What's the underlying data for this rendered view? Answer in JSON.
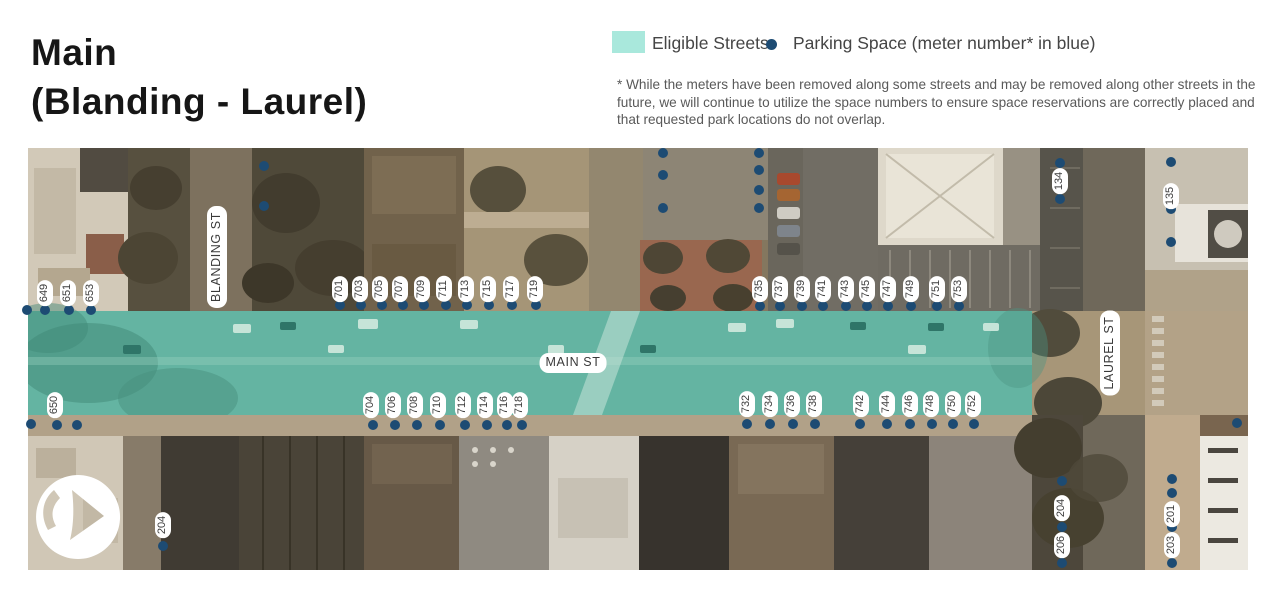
{
  "title": {
    "line1": "Main",
    "line2": "(Blanding - Laurel)"
  },
  "legend": {
    "eligible_label": "Eligible Streets",
    "parking_label": "Parking Space (meter number* in blue)",
    "eligible_color": "#a9e8dc",
    "dot_color": "#1d4b73"
  },
  "disclaimer": "* While the meters have been removed along some streets and may be removed along other streets in the future, we will continue to utilize the space numbers to ensure space reservations are correctly placed and that requested park locations do not overlap.",
  "map": {
    "overlay_color": "#64b4a2",
    "street_labels": [
      {
        "text": "BLANDING ST",
        "x": 217,
        "y": 257,
        "vertical": true
      },
      {
        "text": "MAIN ST",
        "x": 573,
        "y": 363,
        "vertical": false
      },
      {
        "text": "LAUREL ST",
        "x": 1110,
        "y": 353,
        "vertical": true
      }
    ],
    "meters": [
      {
        "num": "649",
        "lx": 45,
        "ly": 293,
        "dx": 45,
        "dy": 310
      },
      {
        "num": "651",
        "lx": 68,
        "ly": 293,
        "dx": 69,
        "dy": 310
      },
      {
        "num": "653",
        "lx": 91,
        "ly": 293,
        "dx": 91,
        "dy": 310
      },
      {
        "num": "701",
        "lx": 340,
        "ly": 289,
        "dx": 340,
        "dy": 305
      },
      {
        "num": "703",
        "lx": 360,
        "ly": 289,
        "dx": 361,
        "dy": 305
      },
      {
        "num": "705",
        "lx": 380,
        "ly": 289,
        "dx": 382,
        "dy": 305
      },
      {
        "num": "707",
        "lx": 400,
        "ly": 289,
        "dx": 403,
        "dy": 305
      },
      {
        "num": "709",
        "lx": 422,
        "ly": 289,
        "dx": 424,
        "dy": 305
      },
      {
        "num": "711",
        "lx": 444,
        "ly": 289,
        "dx": 446,
        "dy": 305
      },
      {
        "num": "713",
        "lx": 466,
        "ly": 289,
        "dx": 467,
        "dy": 305
      },
      {
        "num": "715",
        "lx": 488,
        "ly": 289,
        "dx": 489,
        "dy": 305
      },
      {
        "num": "717",
        "lx": 511,
        "ly": 289,
        "dx": 512,
        "dy": 305
      },
      {
        "num": "719",
        "lx": 535,
        "ly": 289,
        "dx": 536,
        "dy": 305
      },
      {
        "num": "735",
        "lx": 760,
        "ly": 289,
        "dx": 760,
        "dy": 306
      },
      {
        "num": "737",
        "lx": 780,
        "ly": 289,
        "dx": 780,
        "dy": 306
      },
      {
        "num": "739",
        "lx": 802,
        "ly": 289,
        "dx": 802,
        "dy": 306
      },
      {
        "num": "741",
        "lx": 823,
        "ly": 289,
        "dx": 823,
        "dy": 306
      },
      {
        "num": "743",
        "lx": 846,
        "ly": 289,
        "dx": 846,
        "dy": 306
      },
      {
        "num": "745",
        "lx": 867,
        "ly": 289,
        "dx": 867,
        "dy": 306
      },
      {
        "num": "747",
        "lx": 888,
        "ly": 289,
        "dx": 888,
        "dy": 306
      },
      {
        "num": "749",
        "lx": 911,
        "ly": 289,
        "dx": 911,
        "dy": 306
      },
      {
        "num": "751",
        "lx": 937,
        "ly": 289,
        "dx": 937,
        "dy": 306
      },
      {
        "num": "753",
        "lx": 959,
        "ly": 289,
        "dx": 959,
        "dy": 306
      },
      {
        "num": "134",
        "lx": 1060,
        "ly": 181,
        "dx": 1060,
        "dy": 199
      },
      {
        "num": "135",
        "lx": 1171,
        "ly": 196,
        "dx": 1171,
        "dy": 209
      },
      {
        "num": "650",
        "lx": 55,
        "ly": 405,
        "dx": 57,
        "dy": 425
      },
      {
        "num": "704",
        "lx": 371,
        "ly": 405,
        "dx": 373,
        "dy": 425
      },
      {
        "num": "706",
        "lx": 393,
        "ly": 405,
        "dx": 395,
        "dy": 425
      },
      {
        "num": "708",
        "lx": 415,
        "ly": 405,
        "dx": 417,
        "dy": 425
      },
      {
        "num": "710",
        "lx": 438,
        "ly": 405,
        "dx": 440,
        "dy": 425
      },
      {
        "num": "712",
        "lx": 463,
        "ly": 405,
        "dx": 465,
        "dy": 425
      },
      {
        "num": "714",
        "lx": 485,
        "ly": 405,
        "dx": 487,
        "dy": 425
      },
      {
        "num": "716",
        "lx": 505,
        "ly": 405,
        "dx": 507,
        "dy": 425
      },
      {
        "num": "718",
        "lx": 520,
        "ly": 405,
        "dx": 522,
        "dy": 425
      },
      {
        "num": "732",
        "lx": 747,
        "ly": 404,
        "dx": 747,
        "dy": 424
      },
      {
        "num": "734",
        "lx": 770,
        "ly": 404,
        "dx": 770,
        "dy": 424
      },
      {
        "num": "736",
        "lx": 792,
        "ly": 404,
        "dx": 793,
        "dy": 424
      },
      {
        "num": "738",
        "lx": 814,
        "ly": 404,
        "dx": 815,
        "dy": 424
      },
      {
        "num": "742",
        "lx": 861,
        "ly": 404,
        "dx": 860,
        "dy": 424
      },
      {
        "num": "744",
        "lx": 887,
        "ly": 404,
        "dx": 887,
        "dy": 424
      },
      {
        "num": "746",
        "lx": 910,
        "ly": 404,
        "dx": 910,
        "dy": 424
      },
      {
        "num": "748",
        "lx": 931,
        "ly": 404,
        "dx": 932,
        "dy": 424
      },
      {
        "num": "750",
        "lx": 953,
        "ly": 404,
        "dx": 953,
        "dy": 424
      },
      {
        "num": "752",
        "lx": 973,
        "ly": 404,
        "dx": 974,
        "dy": 424
      },
      {
        "num": "204",
        "lx": 163,
        "ly": 525,
        "dx": 163,
        "dy": 546
      },
      {
        "num": "204",
        "lx": 1062,
        "ly": 508,
        "dx": 1062,
        "dy": 527
      },
      {
        "num": "206",
        "lx": 1062,
        "ly": 545,
        "dx": 1062,
        "dy": 563
      },
      {
        "num": "201",
        "lx": 1172,
        "ly": 514,
        "dx": 1172,
        "dy": 493
      },
      {
        "num": "203",
        "lx": 1172,
        "ly": 545,
        "dx": 1172,
        "dy": 563
      }
    ],
    "extra_dots": [
      {
        "x": 264,
        "y": 166
      },
      {
        "x": 264,
        "y": 206
      },
      {
        "x": 663,
        "y": 153
      },
      {
        "x": 663,
        "y": 175
      },
      {
        "x": 663,
        "y": 208
      },
      {
        "x": 759,
        "y": 153
      },
      {
        "x": 759,
        "y": 170
      },
      {
        "x": 759,
        "y": 190
      },
      {
        "x": 759,
        "y": 208
      },
      {
        "x": 1060,
        "y": 163
      },
      {
        "x": 1171,
        "y": 162
      },
      {
        "x": 1171,
        "y": 242
      },
      {
        "x": 27,
        "y": 310
      },
      {
        "x": 31,
        "y": 424
      },
      {
        "x": 77,
        "y": 425
      },
      {
        "x": 1237,
        "y": 423
      },
      {
        "x": 1062,
        "y": 481
      },
      {
        "x": 1172,
        "y": 479
      },
      {
        "x": 1172,
        "y": 527
      }
    ]
  }
}
